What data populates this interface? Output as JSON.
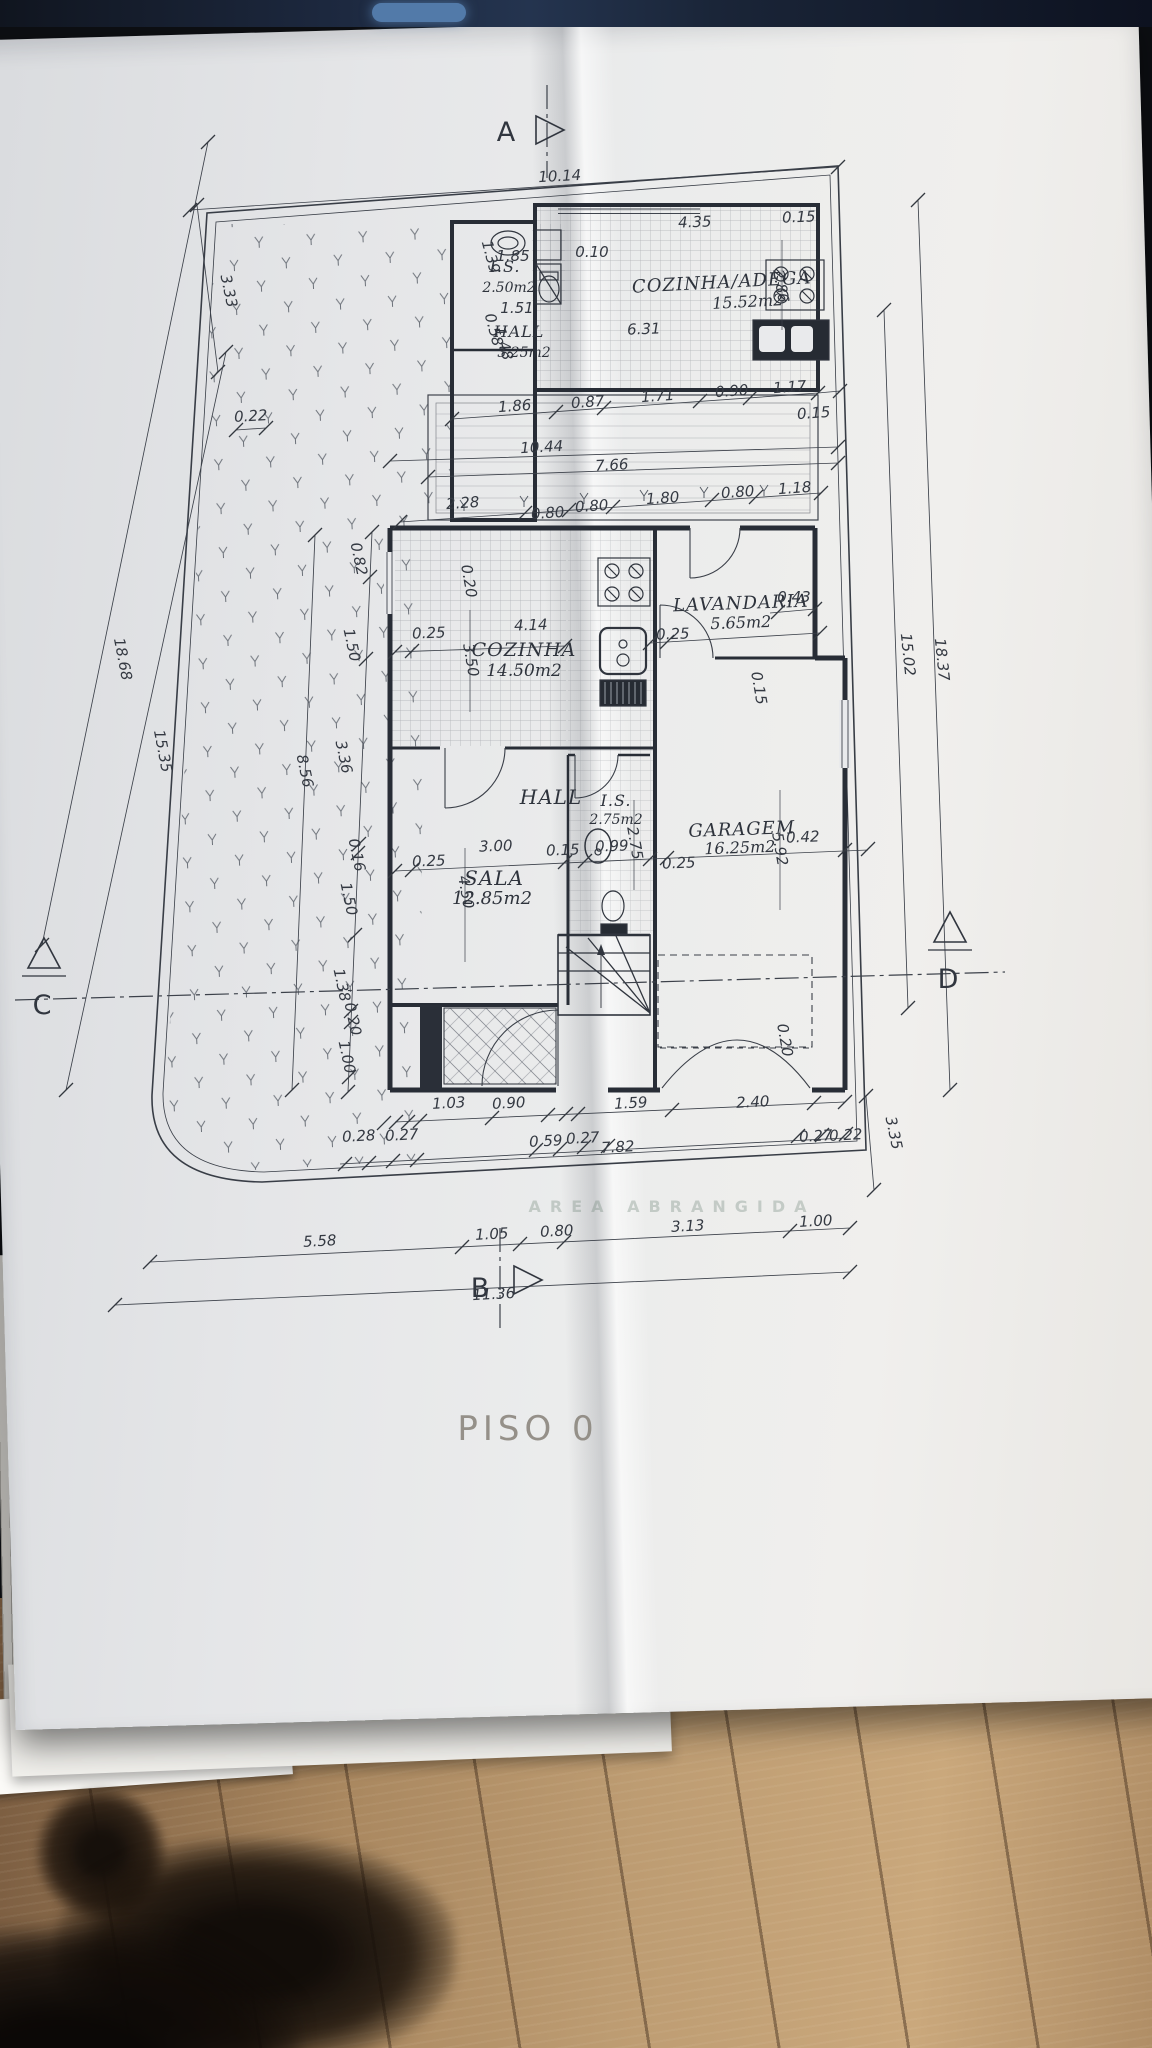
{
  "document": {
    "title": "PISO  0",
    "faded_note": "AREA  ABRANGIDA",
    "section_markers": {
      "a": "A",
      "b": "B",
      "c": "C",
      "d": "D"
    }
  },
  "colors": {
    "paper": "#e9eaec",
    "ink": "#32373f",
    "wood_floor": "#b2906a",
    "top_strip": "#1c2738",
    "accent_blue": "#527aa9",
    "title_gray": "#8e8981",
    "faded_note_green": "#6f8578"
  },
  "plan": {
    "rooms": [
      {
        "name": "I.S.",
        "area": "2.50m2",
        "x": 505,
        "y": 272,
        "ax": 509,
        "ay": 292,
        "fs": 16
      },
      {
        "name": "HALL",
        "area": "3.25m2",
        "x": 519,
        "y": 337,
        "ax": 524,
        "ay": 357,
        "fs": 16
      },
      {
        "name": "COZINHA/ADEGA",
        "area": "15.52m2",
        "x": 722,
        "y": 288,
        "ax": 748,
        "ay": 307,
        "fs": 18,
        "r": -3
      },
      {
        "name": "COZINHA",
        "area": "14.50m2",
        "x": 524,
        "y": 656,
        "ax": 524,
        "ay": 676,
        "fs": 19
      },
      {
        "name": "LAVANDARIA",
        "area": "5.65m2",
        "x": 741,
        "y": 609,
        "ax": 741,
        "ay": 628,
        "fs": 18,
        "r": -2
      },
      {
        "name": "HALL",
        "area": "",
        "x": 551,
        "y": 804,
        "fs": 20
      },
      {
        "name": "I.S.",
        "area": "2.75m2",
        "x": 616,
        "y": 806,
        "ax": 616,
        "ay": 824,
        "fs": 16
      },
      {
        "name": "SALA",
        "area": "12.85m2",
        "x": 494,
        "y": 885,
        "ax": 492,
        "ay": 904,
        "fs": 20
      },
      {
        "name": "GARAGEM",
        "area": "16.25m2",
        "x": 742,
        "y": 835,
        "ax": 740,
        "ay": 853,
        "fs": 18,
        "r": -2
      }
    ],
    "dimensions": [
      {
        "v": "10.14",
        "x": 560,
        "y": 181,
        "r": -3
      },
      {
        "v": "3.33",
        "x": 224,
        "y": 292,
        "r": 78
      },
      {
        "v": "0.22",
        "x": 251,
        "y": 421,
        "r": -3
      },
      {
        "v": "18.68",
        "x": 118,
        "y": 660,
        "r": 79
      },
      {
        "v": "15.35",
        "x": 158,
        "y": 752,
        "r": 79
      },
      {
        "v": "1.85",
        "x": 513,
        "y": 261
      },
      {
        "v": "1.39",
        "x": 486,
        "y": 258,
        "r": 75
      },
      {
        "v": "1.51",
        "x": 517,
        "y": 313
      },
      {
        "v": "0.58",
        "x": 489,
        "y": 331,
        "r": 75
      },
      {
        "v": "1.48",
        "x": 499,
        "y": 345,
        "r": 75
      },
      {
        "v": "0.10",
        "x": 592,
        "y": 257
      },
      {
        "v": "4.35",
        "x": 695,
        "y": 227,
        "r": -2
      },
      {
        "v": "6.31",
        "x": 644,
        "y": 334,
        "r": -2
      },
      {
        "v": "0.15",
        "x": 799,
        "y": 222,
        "r": -2
      },
      {
        "v": "2.86",
        "x": 776,
        "y": 287,
        "r": 80
      },
      {
        "v": "1.86",
        "x": 515,
        "y": 411,
        "r": -4
      },
      {
        "v": "0.87",
        "x": 588,
        "y": 407,
        "r": -4
      },
      {
        "v": "1.71",
        "x": 658,
        "y": 401,
        "r": -4
      },
      {
        "v": "0.90",
        "x": 732,
        "y": 396,
        "r": -4
      },
      {
        "v": "1.17",
        "x": 790,
        "y": 392,
        "r": -4
      },
      {
        "v": "0.15",
        "x": 814,
        "y": 418,
        "r": -4
      },
      {
        "v": "10.44",
        "x": 542,
        "y": 452,
        "r": -3
      },
      {
        "v": "7.66",
        "x": 612,
        "y": 470,
        "r": -3
      },
      {
        "v": "2.28",
        "x": 463,
        "y": 508,
        "r": -4
      },
      {
        "v": "0.80",
        "x": 548,
        "y": 518,
        "r": -4
      },
      {
        "v": "0.80",
        "x": 592,
        "y": 511,
        "r": -4
      },
      {
        "v": "1.80",
        "x": 663,
        "y": 503,
        "r": -4
      },
      {
        "v": "0.80",
        "x": 738,
        "y": 497,
        "r": -4
      },
      {
        "v": "1.18",
        "x": 795,
        "y": 493,
        "r": -4
      },
      {
        "v": "0.82",
        "x": 354,
        "y": 560,
        "r": 78
      },
      {
        "v": "1.50",
        "x": 347,
        "y": 646,
        "r": 78
      },
      {
        "v": "3.36",
        "x": 339,
        "y": 758,
        "r": 78
      },
      {
        "v": "8.56",
        "x": 300,
        "y": 772,
        "r": 78
      },
      {
        "v": "0.16",
        "x": 352,
        "y": 856,
        "r": 78
      },
      {
        "v": "1.50",
        "x": 344,
        "y": 900,
        "r": 78
      },
      {
        "v": "1.38",
        "x": 337,
        "y": 986,
        "r": 78
      },
      {
        "v": "0.20",
        "x": 348,
        "y": 1020,
        "r": 78
      },
      {
        "v": "1.00",
        "x": 342,
        "y": 1058,
        "r": 78
      },
      {
        "v": "0.20",
        "x": 464,
        "y": 582,
        "r": 80
      },
      {
        "v": "4.14",
        "x": 531,
        "y": 630,
        "r": -2
      },
      {
        "v": "0.25",
        "x": 429,
        "y": 638,
        "r": -2
      },
      {
        "v": "3.50",
        "x": 466,
        "y": 661,
        "r": 80
      },
      {
        "v": "0.43",
        "x": 794,
        "y": 602
      },
      {
        "v": "0.25",
        "x": 673,
        "y": 639,
        "r": -2
      },
      {
        "v": "0.15",
        "x": 754,
        "y": 689,
        "r": 80
      },
      {
        "v": "0.15",
        "x": 563,
        "y": 855,
        "r": -2
      },
      {
        "v": "0.99",
        "x": 612,
        "y": 851,
        "r": -2
      },
      {
        "v": "2.75",
        "x": 630,
        "y": 844,
        "r": 80
      },
      {
        "v": "0.25",
        "x": 679,
        "y": 868,
        "r": -2
      },
      {
        "v": "3.00",
        "x": 496,
        "y": 851,
        "r": -2
      },
      {
        "v": "0.25",
        "x": 429,
        "y": 866,
        "r": -2
      },
      {
        "v": "4.50",
        "x": 461,
        "y": 893,
        "r": 80
      },
      {
        "v": "0.42",
        "x": 803,
        "y": 842,
        "r": -2
      },
      {
        "v": "5.92",
        "x": 775,
        "y": 850,
        "r": 80
      },
      {
        "v": "0.20",
        "x": 780,
        "y": 1041,
        "r": 80
      },
      {
        "v": "1.03",
        "x": 449,
        "y": 1108,
        "r": -3
      },
      {
        "v": "0.90",
        "x": 509,
        "y": 1108,
        "r": -3
      },
      {
        "v": "1.59",
        "x": 631,
        "y": 1108,
        "r": -3
      },
      {
        "v": "2.40",
        "x": 753,
        "y": 1107,
        "r": -3
      },
      {
        "v": "0.28",
        "x": 359,
        "y": 1141,
        "r": -3
      },
      {
        "v": "0.27",
        "x": 402,
        "y": 1140,
        "r": -3
      },
      {
        "v": "0.59",
        "x": 546,
        "y": 1146,
        "r": -3
      },
      {
        "v": "0.27",
        "x": 583,
        "y": 1143,
        "r": -3
      },
      {
        "v": "7.82",
        "x": 618,
        "y": 1152,
        "r": -3
      },
      {
        "v": "0.27",
        "x": 816,
        "y": 1141,
        "r": -3
      },
      {
        "v": "0.22",
        "x": 846,
        "y": 1140,
        "r": -3
      },
      {
        "v": "3.35",
        "x": 889,
        "y": 1134,
        "r": 78
      },
      {
        "v": "15.02",
        "x": 903,
        "y": 655,
        "r": 84
      },
      {
        "v": "18.37",
        "x": 937,
        "y": 660,
        "r": 84
      },
      {
        "v": "5.58",
        "x": 320,
        "y": 1246,
        "r": -3
      },
      {
        "v": "1.05",
        "x": 492,
        "y": 1239,
        "r": -3
      },
      {
        "v": "0.80",
        "x": 557,
        "y": 1236,
        "r": -3
      },
      {
        "v": "3.13",
        "x": 688,
        "y": 1231,
        "r": -3
      },
      {
        "v": "1.00",
        "x": 816,
        "y": 1226,
        "r": -3
      },
      {
        "v": "11.36",
        "x": 494,
        "y": 1299,
        "r": -3
      }
    ]
  }
}
